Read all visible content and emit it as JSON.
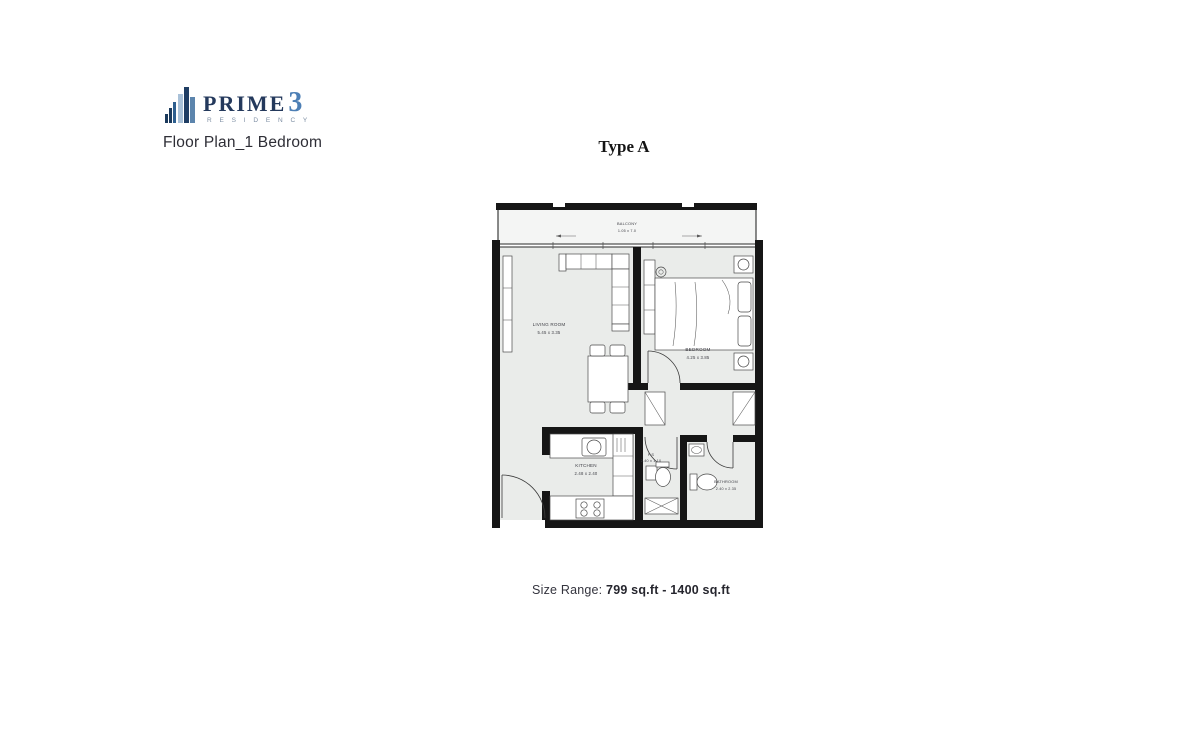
{
  "header": {
    "logo": {
      "brand": "PRIME",
      "brand_number": "3",
      "sub_brand": "R E S I D E N C Y",
      "icon": "building-bars-icon",
      "colors": {
        "brand_text": "#24395c",
        "number": "#4d7fb5",
        "bars": [
          "#1b3a5c",
          "#a9c1d8",
          "#1f3d63",
          "#5c85ad"
        ]
      }
    },
    "subtitle": "Floor Plan_1 Bedroom"
  },
  "plan": {
    "title": "Type A",
    "rooms": [
      {
        "name": "BALCONY",
        "dimensions": "1.05 x 7.0"
      },
      {
        "name": "LIVING ROOM",
        "dimensions": "5.45 x 3.35"
      },
      {
        "name": "BEDROOM",
        "dimensions": "4.25 x 3.85"
      },
      {
        "name": "KITCHEN",
        "dimensions": "2.48 x 2.40"
      },
      {
        "name": "P.S",
        "dimensions": "2.40 x 1.10"
      },
      {
        "name": "BATHROOM",
        "dimensions": "2.40 x 2.35"
      }
    ],
    "colors": {
      "wall": "#161616",
      "floor": "#eaecea",
      "balcony_floor": "#f4f5f4",
      "furniture_stroke": "#4a4a4a",
      "label": "#3d3d44"
    }
  },
  "footer": {
    "size_range_label": "Size Range:",
    "size_range_value": "799 sq.ft - 1400 sq.ft"
  }
}
